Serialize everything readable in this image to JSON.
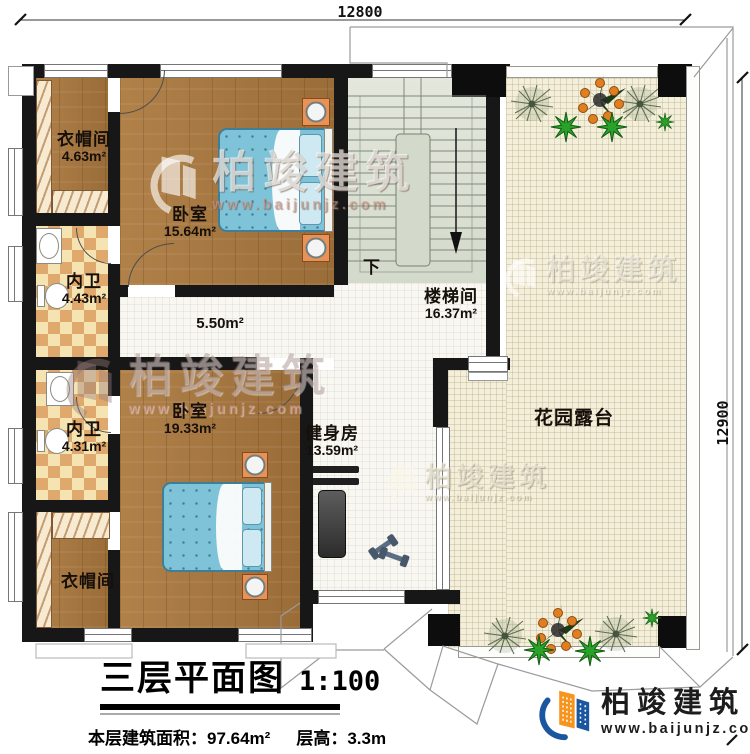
{
  "plan": {
    "title": "三层平面图",
    "scale": "1:100",
    "floor_area_label": "本层建筑面积：",
    "floor_area_value": "97.64m²",
    "floor_height_label": "层高：",
    "floor_height_value": "3.3m"
  },
  "dimensions": {
    "top_width": "12800",
    "right_height": "12900"
  },
  "rooms": {
    "cloakroom_top": {
      "name": "衣帽间",
      "area": "4.63m²"
    },
    "bedroom_top": {
      "name": "卧室",
      "area": "15.64m²"
    },
    "bathroom_top": {
      "name": "内卫",
      "area": "4.43m²"
    },
    "bathroom_bottom": {
      "name": "内卫",
      "area": "4.31m²"
    },
    "bedroom_bottom": {
      "name": "卧室",
      "area": "19.33m²"
    },
    "cloakroom_bottom": {
      "name": "衣帽间"
    },
    "stairwell": {
      "name": "楼梯间",
      "area": "16.37m²",
      "stair_direction": "下"
    },
    "hallway": {
      "area": "5.50m²"
    },
    "gym": {
      "name": "健身房",
      "area": "13.59m²"
    },
    "garden_terrace": {
      "name": "花园露台"
    }
  },
  "branding": {
    "watermark_brand": "柏竣建筑",
    "watermark_url": "www.baijunjz.com",
    "logo_brand": "柏竣建筑",
    "logo_url": "www.baijunjz.com"
  },
  "colors": {
    "wall": "#171717",
    "wood_floor": "#a87a43",
    "bathroom_tile_dark": "#dfa96d",
    "bathroom_tile_light": "#f6e3b2",
    "stair_floor": "#dce1d5",
    "terrace_floor": "#f3efdb",
    "bed": "#7fc3d9",
    "nightstand": "#e89257",
    "logo_blue": "#1a57a0",
    "logo_orange": "#f7941d"
  }
}
